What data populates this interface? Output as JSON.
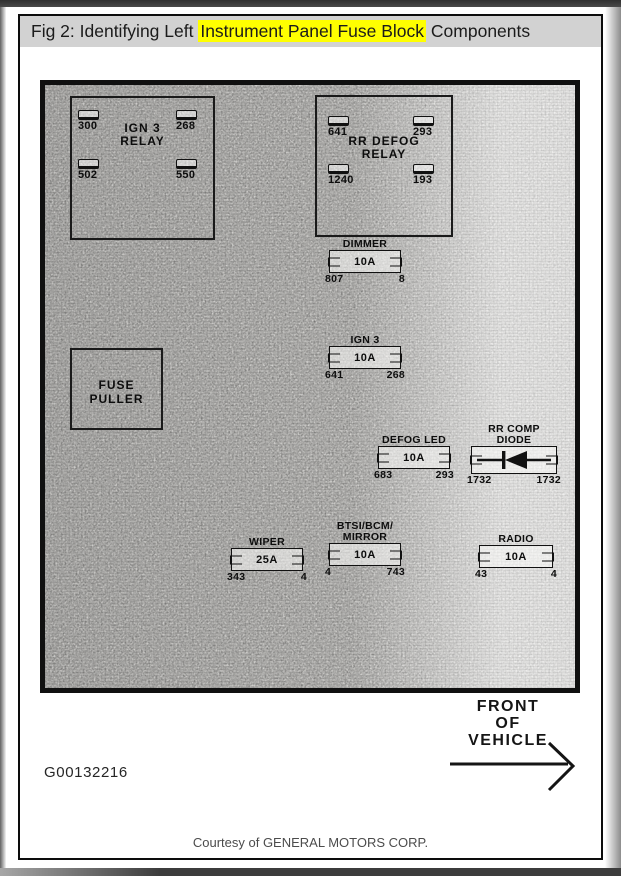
{
  "header": {
    "title_prefix": "Fig 2: Identifying Left ",
    "title_highlight": "Instrument Panel Fuse Block",
    "title_suffix": " Components",
    "highlight_color": "#ffff00",
    "bar_color": "#d2d2d2"
  },
  "figure": {
    "code": "G00132216",
    "courtesy": "Courtesy of GENERAL MOTORS CORP.",
    "front_arrow_lines": [
      "FRONT",
      "OF",
      "VEHICLE"
    ],
    "front_arrow_icon": "right-arrow-icon"
  },
  "relays": [
    {
      "id": "ign3-relay",
      "label_lines": [
        "IGN 3",
        "RELAY"
      ],
      "terminals": [
        {
          "pos": "top-left",
          "value": "300"
        },
        {
          "pos": "top-right",
          "value": "268"
        },
        {
          "pos": "bottom-left",
          "value": "502"
        },
        {
          "pos": "bottom-right",
          "value": "550"
        }
      ]
    },
    {
      "id": "rr-defog-relay",
      "label_lines": [
        "RR DEFOG",
        "RELAY"
      ],
      "terminals": [
        {
          "pos": "top-left",
          "value": "641"
        },
        {
          "pos": "top-right",
          "value": "293"
        },
        {
          "pos": "bottom-left",
          "value": "1240"
        },
        {
          "pos": "bottom-right",
          "value": "193"
        }
      ]
    }
  ],
  "fuse_puller": {
    "label_lines": [
      "FUSE",
      "PULLER"
    ]
  },
  "fuses": [
    {
      "id": "dimmer",
      "label_lines": [
        "DIMMER"
      ],
      "rating": "10A",
      "left_terminal": "807",
      "right_terminal": "8"
    },
    {
      "id": "ign3-fuse",
      "label_lines": [
        "IGN 3"
      ],
      "rating": "10A",
      "left_terminal": "641",
      "right_terminal": "268"
    },
    {
      "id": "defog-led",
      "label_lines": [
        "DEFOG LED"
      ],
      "rating": "10A",
      "left_terminal": "683",
      "right_terminal": "293"
    },
    {
      "id": "wiper",
      "label_lines": [
        "WIPER"
      ],
      "rating": "25A",
      "left_terminal": "343",
      "right_terminal": "4"
    },
    {
      "id": "btsi-bcm-mirror",
      "label_lines": [
        "BTSI/BCM/",
        "MIRROR"
      ],
      "rating": "10A",
      "left_terminal": "4",
      "right_terminal": "743"
    },
    {
      "id": "radio",
      "label_lines": [
        "RADIO"
      ],
      "rating": "10A",
      "left_terminal": "43",
      "right_terminal": "4"
    }
  ],
  "diode": {
    "id": "rr-comp-diode",
    "label_lines": [
      "RR COMP",
      "DIODE"
    ],
    "left_terminal": "1732",
    "right_terminal": "1732",
    "symbol": "diode-icon"
  }
}
